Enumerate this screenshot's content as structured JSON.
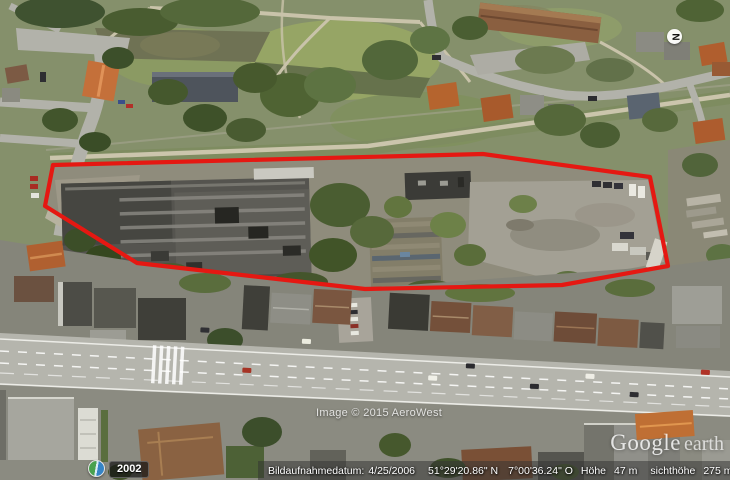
{
  "map": {
    "copyright_watermark": "Image © 2015 AeroWest",
    "logo_google": "Google",
    "logo_earth": "earth",
    "compass_letter": "N",
    "site_outline_color": "#e51812"
  },
  "timeline": {
    "year": "2002"
  },
  "status_bar": {
    "imagery_date_label": "Bildaufnahmedatum:",
    "imagery_date": "4/25/2006",
    "latitude": "51°29'20.86\" N",
    "longitude": "7°00'36.24\" O",
    "elevation_label": "Höhe",
    "elevation_value": "47 m",
    "eye_altitude_label": "sichthöhe",
    "eye_altitude_value": "275 m"
  }
}
